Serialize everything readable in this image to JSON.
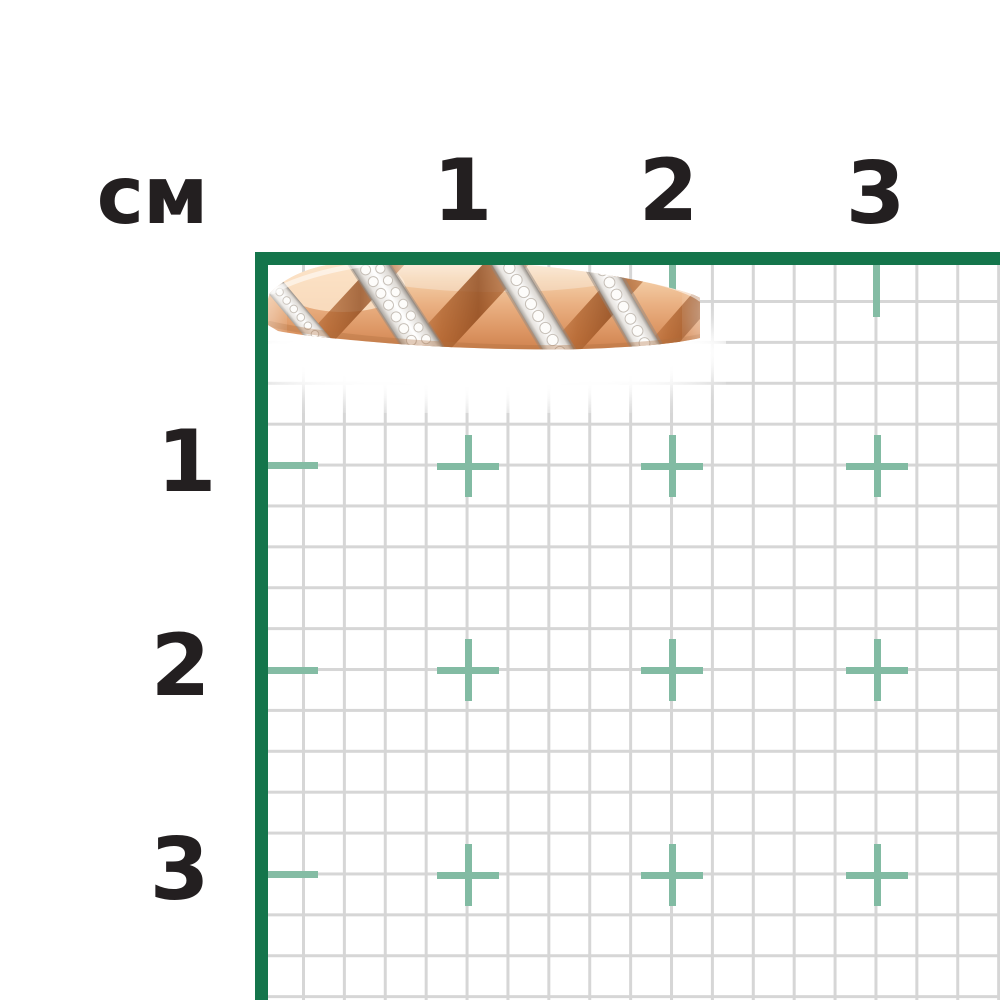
{
  "ruler": {
    "unit_label": "см",
    "top_ticks": [
      "1",
      "2",
      "3"
    ],
    "left_ticks": [
      "1",
      "2",
      "3"
    ]
  },
  "colors": {
    "frame_green": "#14754b",
    "tick_mark_green": "#82bba3",
    "grid_line_gray": "#d6d6d6",
    "label_dark": "#231f20",
    "ring_gold_light": "#f4cfa8",
    "ring_gold_deep": "#c87f42",
    "ring_pave_silver": "#e9e6e2"
  },
  "ring": {
    "alt": "rose gold band ring with diagonal diamond pavé stripes"
  }
}
